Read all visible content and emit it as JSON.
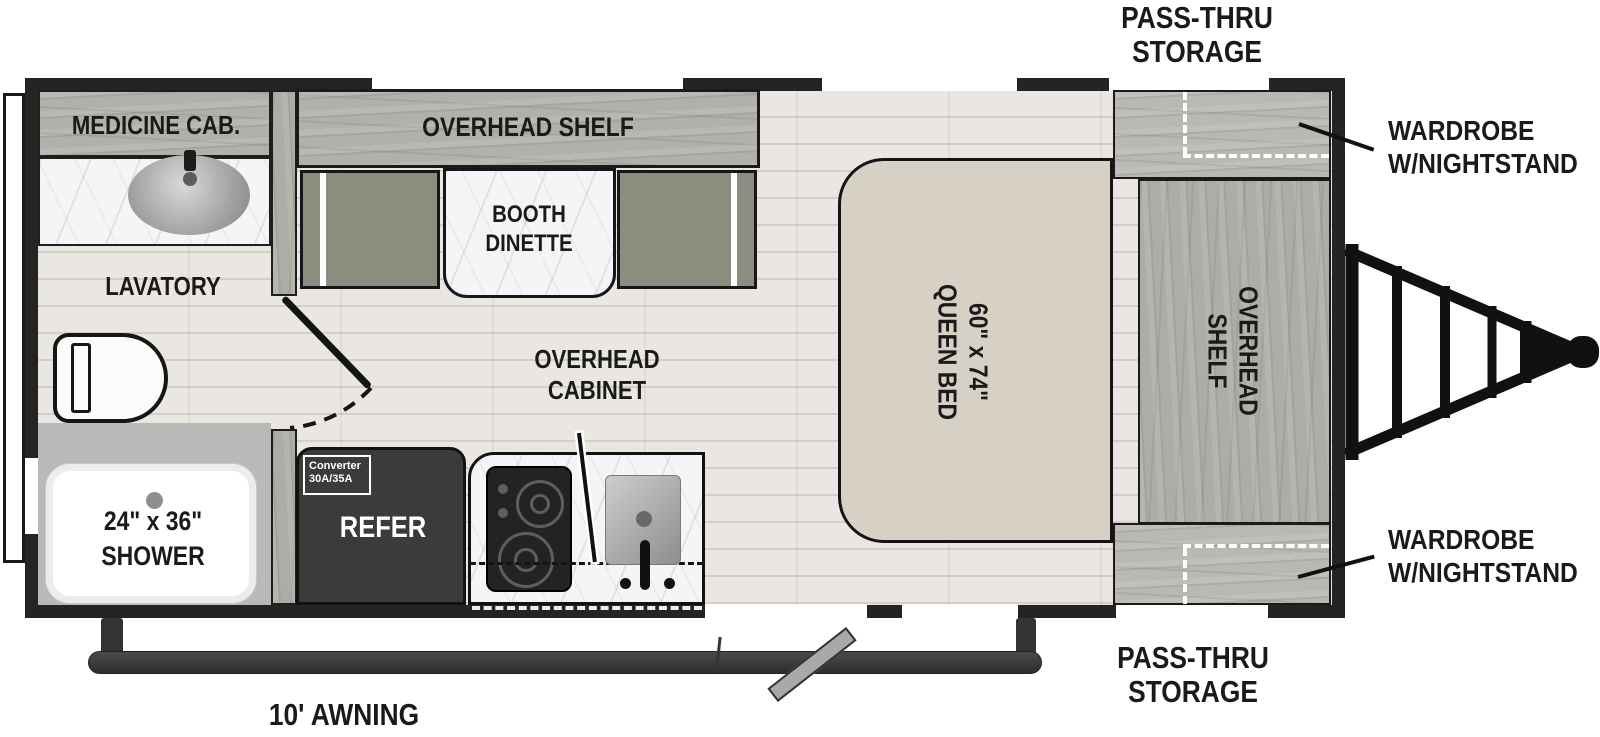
{
  "fp": {
    "exterior": {
      "pass_thru_top_l1": "PASS-THRU",
      "pass_thru_top_l2": "STORAGE",
      "wardrobe_top_l1": "WARDROBE",
      "wardrobe_top_l2": "W/NIGHTSTAND",
      "wardrobe_bottom_l1": "WARDROBE",
      "wardrobe_bottom_l2": "W/NIGHTSTAND",
      "pass_thru_bottom_l1": "PASS-THRU",
      "pass_thru_bottom_l2": "STORAGE",
      "awning": "10' AWNING"
    },
    "bathroom": {
      "medicine_cab": "MEDICINE CAB.",
      "lavatory": "LAVATORY",
      "shower_l1": "24\" x 36\"",
      "shower_l2": "SHOWER"
    },
    "kitchen": {
      "overhead_shelf": "OVERHEAD SHELF",
      "booth_l1": "BOOTH",
      "booth_l2": "DINETTE",
      "overhead_cabinet_l1": "OVERHEAD",
      "overhead_cabinet_l2": "CABINET",
      "converter_l1": "Converter",
      "converter_l2": "30A/35A",
      "refer": "REFER"
    },
    "bedroom": {
      "bed_l1": "60\" x 74\"",
      "bed_l2": "QUEEN BED",
      "shelf_l1": "OVERHEAD",
      "shelf_l2": "SHELF"
    },
    "colors": {
      "wall": "#242424",
      "floor": "#eae6e1",
      "wood": "#b2b0aa",
      "bed": "#d6d0c5",
      "bench": "#8d8d7f",
      "refer": "#3b3b3b",
      "shower_floor": "#b9b9b9",
      "marble": "#f4f5f6"
    }
  }
}
